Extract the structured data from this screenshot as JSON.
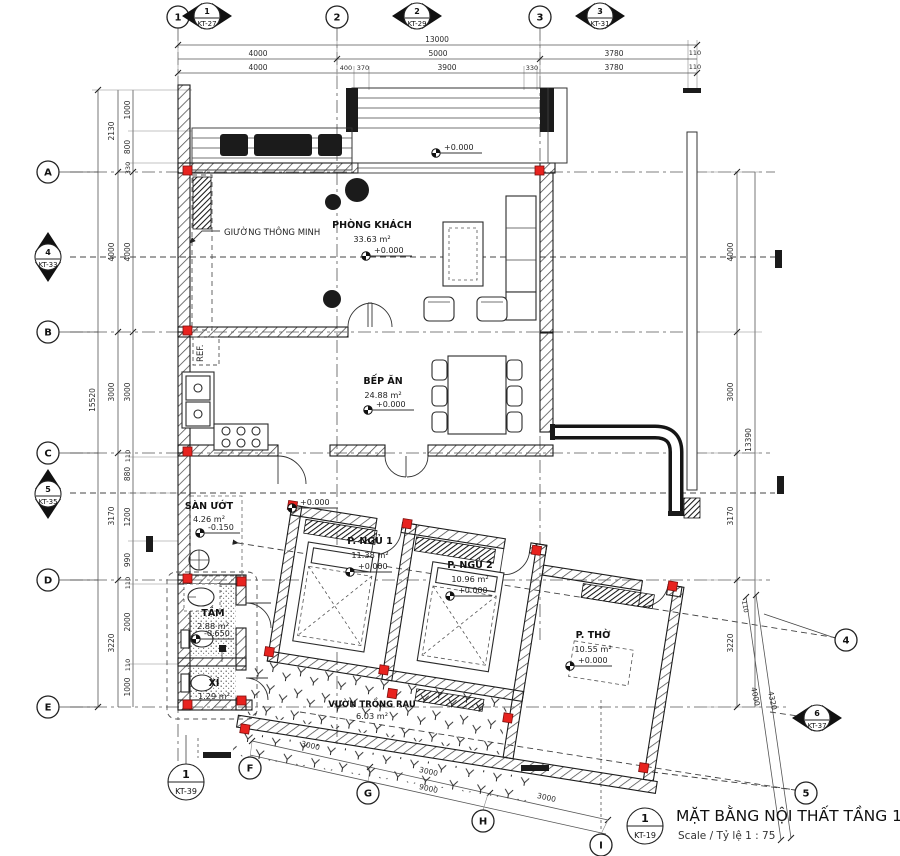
{
  "title_block": {
    "number": "1",
    "sheet": "KT-19",
    "title": "MẶT BẰNG NỘI THẤT TẦNG 1",
    "scale": "Scale / Tỷ lệ  1 : 75"
  },
  "grid_markers": {
    "top_cols": [
      "1",
      "2",
      "3"
    ],
    "left_rows": [
      "A",
      "B",
      "C",
      "D",
      "E"
    ],
    "bottom_cols": [
      "F",
      "G",
      "H",
      "I"
    ],
    "right_circles": [
      "4",
      "5"
    ],
    "detail_refs": [
      {
        "num": "1",
        "sheet": "KT-27"
      },
      {
        "num": "2",
        "sheet": "KT-29"
      },
      {
        "num": "3",
        "sheet": "KT-31"
      },
      {
        "num": "4",
        "sheet": "KT-33"
      },
      {
        "num": "5",
        "sheet": "KT-35"
      },
      {
        "num": "6",
        "sheet": "KT-37"
      }
    ],
    "section_ref": {
      "num": "1",
      "sheet": "KT-39"
    }
  },
  "rooms": [
    {
      "name": "PHÒNG KHÁCH",
      "area": "33.63 m²",
      "level": "+0.000"
    },
    {
      "name": "BẾP ĂN",
      "area": "24.88 m²",
      "level": "+0.000"
    },
    {
      "name": "SÀN ƯỚT",
      "area": "4.26 m²",
      "level": "-0.150"
    },
    {
      "name": "P. NGỦ 1",
      "area": "11.38 m²",
      "level": "+0.000"
    },
    {
      "name": "P. NGỦ 2",
      "area": "10.96 m²",
      "level": "+0.000"
    },
    {
      "name": "P. THỜ",
      "area": "10.55 m²",
      "level": "+0.000"
    },
    {
      "name": "TẮM",
      "area": "2.88 m²",
      "level": "-0.650"
    },
    {
      "name": "XÍ",
      "area": "1.29 m²"
    },
    {
      "name": "VƯỜN TRỒNG RAU",
      "area": "6.03 m²"
    }
  ],
  "annotations": {
    "smart_bed": "GIƯỜNG THÔNG MINH",
    "fridge": "REF.",
    "porch_level": "+0.000",
    "hall_level": "+0.000"
  },
  "dimensions": {
    "top_total": "13000",
    "top_major": [
      "4000",
      "5000",
      "3780",
      "110"
    ],
    "top_minor": [
      "4000",
      "400",
      "370",
      "3900",
      "330",
      "3780",
      "110"
    ],
    "left_total": "15520",
    "left_major": [
      "2130",
      "4000",
      "3000",
      "3170",
      "3220"
    ],
    "left_minor": [
      "1000",
      "800",
      "330",
      "4000",
      "3000",
      "110",
      "880",
      "1200",
      "990",
      "110",
      "2000",
      "110",
      "1000"
    ],
    "right_total": "13390",
    "right_major": [
      "4000",
      "3000",
      "3170",
      "3220"
    ],
    "bottom_segments": [
      "3000",
      "3000",
      "3000"
    ],
    "bottom_total": "9000",
    "slant_right": [
      "110",
      "4000",
      "4320"
    ]
  }
}
